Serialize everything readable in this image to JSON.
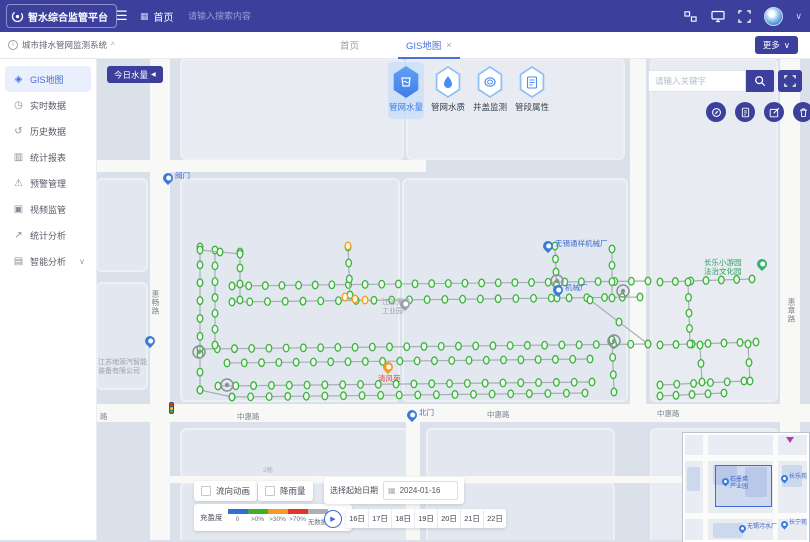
{
  "colors": {
    "indigo": "#3c3f9c",
    "accent_blue": "#3f7ee8",
    "tab_blue": "#4a6fdb",
    "node_green": "#3ab43a",
    "line_gray": "#a9aeb6",
    "orange": "#f59a23"
  },
  "header": {
    "logo_text": "智水综合监管平台",
    "burger": "☰",
    "breadcrumb_icon": "▦",
    "breadcrumb": "首页",
    "search_placeholder": "请输入搜索内容",
    "caret": "∨"
  },
  "tabbar": {
    "system_title": "城市排水管网监测系统",
    "system_caret": "^",
    "tabs": [
      {
        "label": "首页"
      },
      {
        "label": "GIS地图",
        "close": "×"
      }
    ],
    "more_label": "更多",
    "more_caret": "∨"
  },
  "sidebar": {
    "items": [
      {
        "label": "GIS地图",
        "glyph": "◈",
        "icon": "gis-map-icon",
        "active": true
      },
      {
        "label": "实时数据",
        "glyph": "◷",
        "icon": "realtime-data-icon"
      },
      {
        "label": "历史数据",
        "glyph": "↺",
        "icon": "history-data-icon"
      },
      {
        "label": "统计报表",
        "glyph": "▥",
        "icon": "report-icon"
      },
      {
        "label": "预警管理",
        "glyph": "⚠",
        "icon": "alert-manage-icon"
      },
      {
        "label": "视频监管",
        "glyph": "▣",
        "icon": "video-monitor-icon"
      },
      {
        "label": "统计分析",
        "glyph": "↗",
        "icon": "stat-analysis-icon"
      },
      {
        "label": "智能分析",
        "glyph": "▤",
        "icon": "smart-analysis-icon",
        "caret": "∨"
      }
    ]
  },
  "map": {
    "today_button": "今日水量",
    "today_caret": "◀",
    "layer_tabs": [
      {
        "label": "管网水量",
        "icon": "water-volume-icon",
        "active": true
      },
      {
        "label": "管网水质",
        "icon": "water-quality-icon"
      },
      {
        "label": "井盖监测",
        "icon": "manhole-monitor-icon"
      },
      {
        "label": "管段属性",
        "icon": "pipe-attribute-icon"
      }
    ],
    "search_placeholder": "请输入关键字",
    "road_labels": [
      {
        "text": "中惠路",
        "x": 141,
        "y": 353
      },
      {
        "text": "中惠路",
        "x": 391,
        "y": 351
      },
      {
        "text": "中惠路",
        "x": 561,
        "y": 350
      },
      {
        "text": "惠畅路",
        "x": 54,
        "y": 232,
        "v": true
      },
      {
        "text": "惠章路",
        "x": 690,
        "y": 240,
        "v": true
      },
      {
        "text": "路",
        "x": 4,
        "y": 353
      },
      {
        "text": "2栋",
        "x": 167,
        "y": 406,
        "tiny": true
      }
    ],
    "area_labels": [
      {
        "lines": [
          "江苏地源汽智能",
          "装备有限公司"
        ],
        "x": 2,
        "y": 300
      },
      {
        "lines": [
          "江苏无锡",
          "工业园"
        ],
        "x": 286,
        "y": 240
      }
    ],
    "pins": [
      {
        "type": "blue",
        "x": 72,
        "y": 126,
        "label": "阀门",
        "lcolor": "#3a6bd0"
      },
      {
        "type": "blue",
        "x": 54,
        "y": 289,
        "label": "",
        "lcolor": "#3a6bd0"
      },
      {
        "type": "blue",
        "x": 316,
        "y": 363,
        "label": "北门",
        "lcolor": "#3a6bd0"
      },
      {
        "type": "blue",
        "x": 452,
        "y": 194,
        "label": "无锡通祥机械厂",
        "lcolor": "#3a6bd0"
      },
      {
        "type": "blue",
        "x": 462,
        "y": 238,
        "label": "机械厂",
        "lcolor": "#3a6bd0"
      },
      {
        "type": "gray",
        "x": 309,
        "y": 252,
        "label": "",
        "lcolor": "#9aa1ab"
      },
      {
        "type": "green",
        "x": 666,
        "y": 212,
        "label_lines": [
          "长乐小游园",
          "法治文化园"
        ],
        "side": "left",
        "lcolor": "#2f9e5f"
      },
      {
        "type": "orange",
        "x": 292,
        "y": 315,
        "label": "清风苑",
        "below": true,
        "lcolor": "#e63c2e"
      }
    ],
    "stations": [
      [
        103,
        294
      ],
      [
        131,
        327
      ],
      [
        461,
        223
      ],
      [
        527,
        233
      ],
      [
        518,
        283
      ]
    ],
    "traffic_light": {
      "x": 73,
      "y": 344
    },
    "network": {
      "lines": [
        [
          136,
          228,
          552,
          223,
          26
        ],
        [
          564,
          224,
          656,
          221,
          7
        ],
        [
          136,
          244,
          544,
          239,
          24
        ],
        [
          104,
          291,
          552,
          286,
          27
        ],
        [
          564,
          287,
          660,
          284,
          7
        ],
        [
          131,
          305,
          494,
          301,
          22
        ],
        [
          122,
          328,
          496,
          324,
          22
        ],
        [
          564,
          327,
          648,
          323,
          6
        ],
        [
          136,
          339,
          489,
          335,
          20
        ],
        [
          564,
          338,
          628,
          335,
          5
        ],
        [
          104,
          189,
          104,
          332,
          9
        ],
        [
          119,
          192,
          119,
          287,
          7
        ],
        [
          144,
          194,
          144,
          242,
          4
        ],
        [
          252,
          189,
          254,
          237,
          4
        ],
        [
          459,
          188,
          461,
          240,
          5
        ],
        [
          516,
          191,
          516,
          240,
          4
        ],
        [
          516,
          282,
          518,
          334,
          4
        ],
        [
          592,
          224,
          594,
          286,
          5
        ],
        [
          604,
          287,
          606,
          324,
          3
        ],
        [
          494,
          242,
          552,
          286,
          3
        ],
        [
          104,
          192,
          144,
          196,
          3
        ],
        [
          104,
          332,
          136,
          339,
          2
        ],
        [
          652,
          286,
          654,
          323,
          3
        ]
      ],
      "orange_nodes": [
        [
          249,
          239
        ],
        [
          259,
          241
        ],
        [
          269,
          242
        ],
        [
          252,
          188
        ]
      ]
    }
  },
  "overlays": {
    "toggles": [
      {
        "label": "流向动画"
      },
      {
        "label": "降雨量"
      }
    ],
    "legend": {
      "title": "充盈度",
      "items": [
        {
          "label": "0",
          "color": "#2f6fd6"
        },
        {
          "label": ">0%",
          "color": "#3fae2a"
        },
        {
          "label": ">30%",
          "color": "#f59a23"
        },
        {
          "label": ">70%",
          "color": "#e6342a"
        },
        {
          "label": "无数据",
          "color": "#aab0b6"
        }
      ]
    },
    "date_panel": {
      "label": "选择起始日期",
      "value": "2024-01-16"
    },
    "days": [
      "16日",
      "17日",
      "18日",
      "19日",
      "20日",
      "21日",
      "22日"
    ]
  },
  "minimap": {
    "viewport": {
      "x": 30,
      "y": 30,
      "w": 55,
      "h": 40
    },
    "pins": [
      {
        "x": 40,
        "y": 50,
        "lines": [
          "石墨烯",
          "产业园"
        ]
      },
      {
        "x": 99,
        "y": 47,
        "lines": [
          "长乐苑"
        ]
      },
      {
        "x": 57,
        "y": 97,
        "lines": [
          "无锡污水厂"
        ]
      },
      {
        "x": 99,
        "y": 93,
        "lines": [
          "长宁苑"
        ]
      }
    ]
  }
}
